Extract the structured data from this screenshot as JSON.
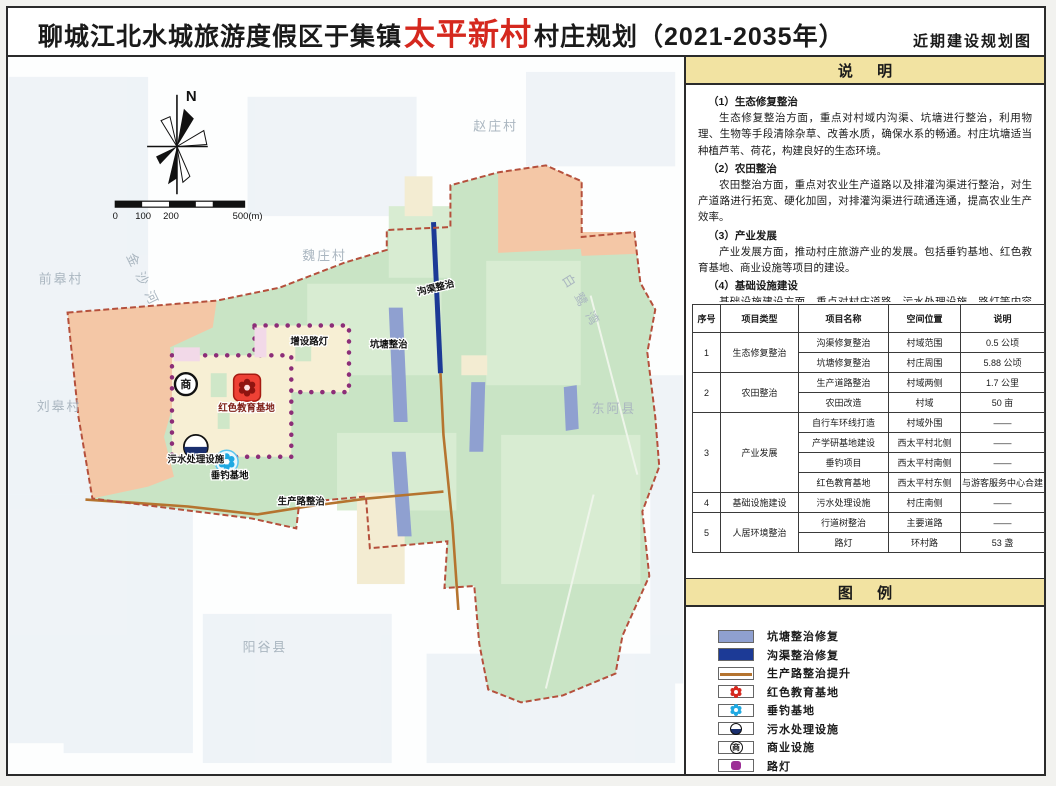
{
  "title": {
    "prefix": "聊城江北水城旅游度假区于集镇",
    "highlight": "太平新村",
    "suffix": "村庄规划（2021-2035年）",
    "right": "近期建设规划图"
  },
  "map": {
    "north": "N",
    "scale_ticks": [
      "0",
      "100",
      "200",
      "500(m)"
    ],
    "places": {
      "zhaozhuang": "赵庄村",
      "weizhuang": "魏庄村",
      "qiangao": "前皋村",
      "liugao": "刘皋村",
      "yanggu": "阳谷县",
      "donge": "东阿县",
      "bailuwan": "白鹭湾",
      "jinshahe": "金沙河"
    },
    "annotations": {
      "canal": "沟渠整治",
      "pond": "坑塘整治",
      "lamps": "增设路灯",
      "rededu": "红色教育基地",
      "sewage": "污水处理设施",
      "fishing": "垂钓基地",
      "road": "生产路整治"
    },
    "icons": {
      "commercial": "商"
    }
  },
  "notes": {
    "header": "说 明",
    "items": [
      {
        "heading": "（1）生态修复整治",
        "body": "生态修复整治方面，重点对村域内沟渠、坑塘进行整治，利用物理、生物等手段清除杂草、改善水质，确保水系的畅通。村庄坑塘适当种植芦苇、荷花，构建良好的生态环境。"
      },
      {
        "heading": "（2）农田整治",
        "body": "农田整治方面，重点对农业生产道路以及排灌沟渠进行整治，对生产道路进行拓宽、硬化加固，对排灌沟渠进行疏通连通，提高农业生产效率。"
      },
      {
        "heading": "（3）产业发展",
        "body": "产业发展方面，推动村庄旅游产业的发展。包括垂钓基地、红色教育基地、商业设施等项目的建设。"
      },
      {
        "heading": "（4）基础设施建设",
        "body": "基础设施建设方面，重点对村庄道路、污水处理设施、路灯等内容进行完善。"
      }
    ]
  },
  "table": {
    "headers": [
      "序号",
      "项目类型",
      "项目名称",
      "空间位置",
      "说明"
    ],
    "groups": [
      {
        "no": "1",
        "type": "生态修复整治",
        "rows": [
          [
            "沟渠修复整治",
            "村域范围",
            "0.5 公顷"
          ],
          [
            "坑塘修复整治",
            "村庄周围",
            "5.88 公顷"
          ]
        ]
      },
      {
        "no": "2",
        "type": "农田整治",
        "rows": [
          [
            "生产道路整治",
            "村域两侧",
            "1.7 公里"
          ],
          [
            "农田改造",
            "村域",
            "50 亩"
          ]
        ]
      },
      {
        "no": "3",
        "type": "产业发展",
        "rows": [
          [
            "自行车环线打造",
            "村域外围",
            "——"
          ],
          [
            "产学研基地建设",
            "西太平村北侧",
            "——"
          ],
          [
            "垂钓项目",
            "西太平村南侧",
            "——"
          ],
          [
            "红色教育基地",
            "西太平村东侧",
            "与游客服务中心合建"
          ]
        ]
      },
      {
        "no": "4",
        "type": "基础设施建设",
        "rows": [
          [
            "污水处理设施",
            "村庄南侧",
            "——"
          ]
        ]
      },
      {
        "no": "5",
        "type": "人居环境整治",
        "rows": [
          [
            "行道树整治",
            "主要道路",
            "——"
          ],
          [
            "路灯",
            "环村路",
            "53 盏"
          ]
        ]
      }
    ]
  },
  "legend": {
    "header": "图 例",
    "items": [
      {
        "label": "坑塘整治修复",
        "type": "pond"
      },
      {
        "label": "沟渠整治修复",
        "type": "canal"
      },
      {
        "label": "生产路整治提升",
        "type": "road"
      },
      {
        "label": "红色教育基地",
        "type": "red-edu"
      },
      {
        "label": "垂钓基地",
        "type": "fishing"
      },
      {
        "label": "污水处理设施",
        "type": "sewage"
      },
      {
        "label": "商业设施",
        "type": "commercial"
      },
      {
        "label": "路灯",
        "type": "streetlamp"
      }
    ]
  },
  "colors": {
    "accent_red": "#d5281e",
    "bar_yellow": "#f2e3a2",
    "pond": "#8fa0d0",
    "canal": "#1c3a96",
    "road": "#b5742f",
    "boundary": "#b5503c",
    "lamp_dot": "#8c2d78",
    "green": "#c9e4c5",
    "salmon": "#f4c7a6",
    "red_icon": "#ee4135",
    "fishing_icon": "#1fa9e2"
  }
}
